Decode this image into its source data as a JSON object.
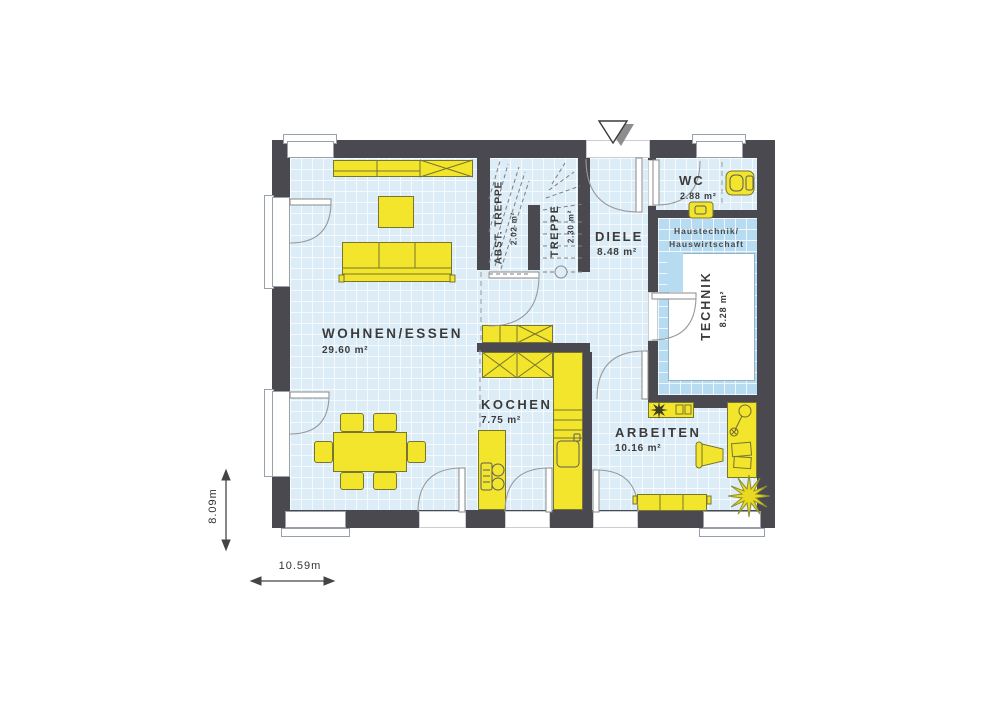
{
  "plan_title": "ground-floor-plan",
  "rooms": {
    "wohnen_essen": {
      "name": "WOHNEN/ESSEN",
      "area": "29.60 m²"
    },
    "kochen": {
      "name": "KOCHEN",
      "area": "7.75 m²"
    },
    "diele": {
      "name": "DIELE",
      "area": "8.48 m²"
    },
    "wc": {
      "name": "WC",
      "area": "2.88 m²"
    },
    "technik": {
      "name": "TECHNIK",
      "area": "8.28 m²",
      "note_line1": "Haustechnik/",
      "note_line2": "Hauswirtschaft"
    },
    "abst_treppe": {
      "name": "ABST. TREPPE",
      "area": "2.02 m²"
    },
    "treppe": {
      "name": "TREPPE",
      "area": "2.30 m²"
    },
    "arbeiten": {
      "name": "ARBEITEN",
      "area": "10.16 m²"
    }
  },
  "dimensions": {
    "width": "10.59m",
    "height": "8.09m"
  },
  "colors": {
    "wall": "#4a4950",
    "floor": "#dcedf8",
    "technik_floor": "#b7dcf2",
    "furniture": "#f3e42c",
    "grid_line": "#ffffff"
  }
}
